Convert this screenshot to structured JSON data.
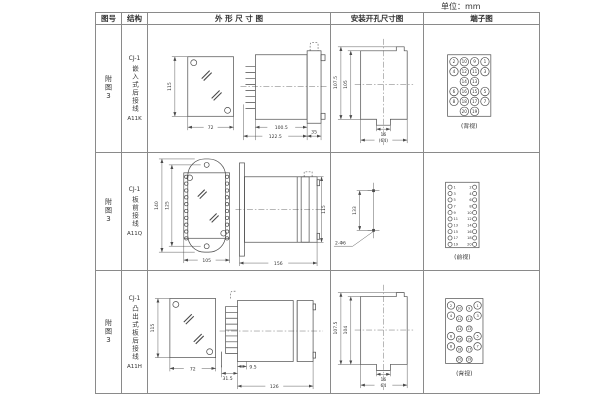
{
  "page": {
    "unit_label": "单位：mm"
  },
  "colors": {
    "background": "#ffffff",
    "line": "#4a4a4a",
    "border": "#8a8a8a",
    "text": "#333333"
  },
  "table": {
    "headers": {
      "fig": "图号",
      "structure": "结构",
      "outline": "外 形 尺 寸 图",
      "mounting": "安装开孔尺寸图",
      "terminal": "端子图"
    },
    "rows": [
      {
        "fig": "附图3",
        "model": "CJ-1",
        "structure": "嵌入式后接线",
        "code": "A11K",
        "outline": {
          "front_height": "115",
          "front_width": "72",
          "depth_inner": "100.5",
          "depth_total": "122.5",
          "flange_depth": "35"
        },
        "mounting": {
          "height_outer": "107.5",
          "height_inner": "105",
          "notch_width": "16",
          "width": "(64)"
        },
        "terminals": [
          "2",
          "10",
          "9",
          "1",
          "4",
          "12",
          "11",
          "3",
          "14",
          "13",
          "6",
          "16",
          "15",
          "5",
          "8",
          "18",
          "17",
          "7",
          "20",
          "19"
        ],
        "terminal_view": "(背视)"
      },
      {
        "fig": "附图3",
        "model": "CJ-1",
        "structure": "板前接线",
        "code": "A11Q",
        "outline": {
          "front_height": "140",
          "hole_spacing": "125",
          "front_width": "105",
          "depth": "156",
          "body_height": "115"
        },
        "mounting": {
          "hole_spacing": "133",
          "hole_label": "2-Φ6"
        },
        "terminals_left": [
          "1",
          "3",
          "5",
          "7",
          "9",
          "11",
          "13",
          "15",
          "17",
          "19"
        ],
        "terminals_right": [
          "2",
          "4",
          "6",
          "8",
          "10",
          "12",
          "14",
          "16",
          "18",
          "20"
        ],
        "terminal_view": "(前视)"
      },
      {
        "fig": "附图3",
        "model": "CJ-1",
        "structure": "凸出式板后接线",
        "code": "A11H",
        "outline": {
          "front_height": "115",
          "front_width": "72",
          "pin_depth": "31.5",
          "gap": "9.5",
          "depth": "126"
        },
        "mounting": {
          "height_outer": "107.5",
          "height_inner": "104",
          "notch_width": "16",
          "width": "64"
        },
        "terminals": [
          "2",
          "10",
          "9",
          "1",
          "4",
          "12",
          "11",
          "3",
          "14",
          "13",
          "6",
          "16",
          "15",
          "5",
          "8",
          "18",
          "17",
          "7",
          "20",
          "19"
        ],
        "terminal_view": "(背视)"
      }
    ]
  }
}
